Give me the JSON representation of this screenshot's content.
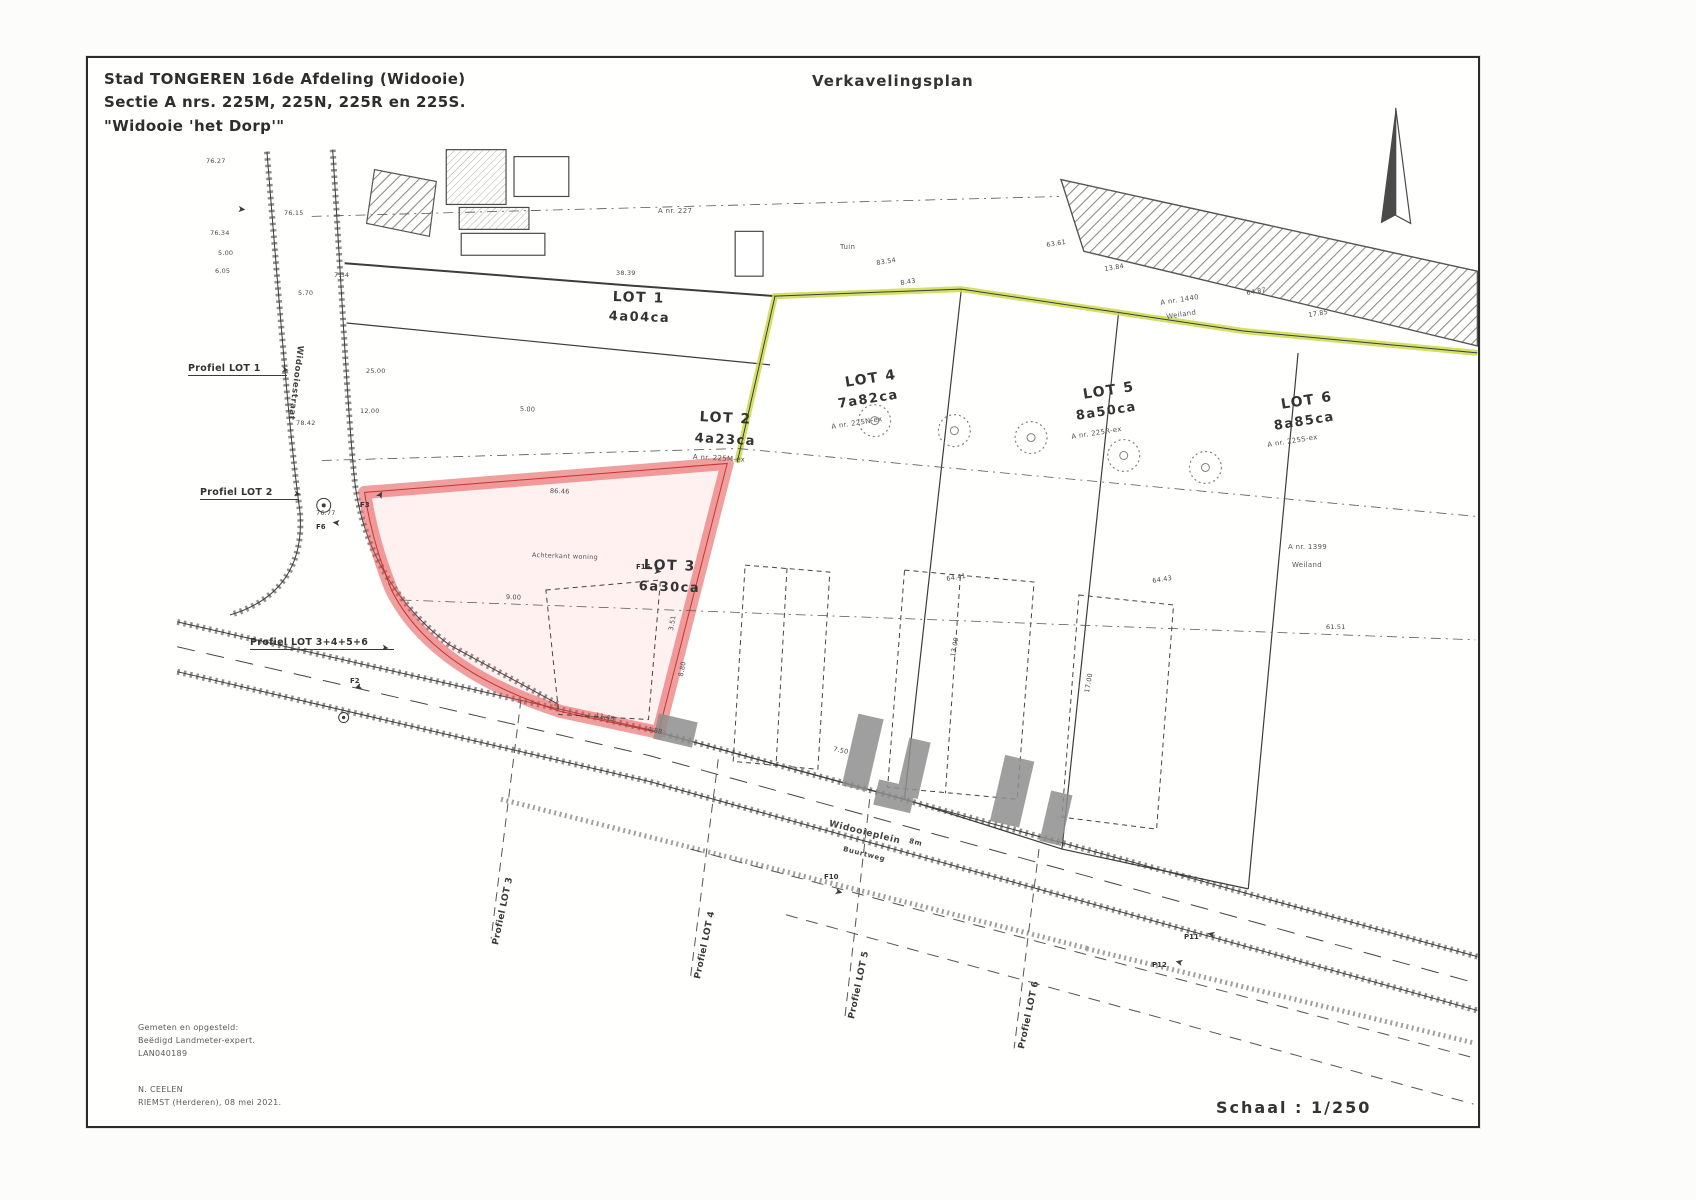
{
  "document": {
    "type": "Verkavelingsplan (subdivision plan)"
  },
  "title_block": {
    "line1": "Stad TONGEREN 16de Afdeling (Widooie)",
    "line2": "Sectie A nrs. 225M, 225N, 225R en 225S.",
    "line3": "\"Widooie 'het Dorp'\""
  },
  "plan_title": "Verkavelingsplan",
  "scale": {
    "label": "Schaal : 1/250"
  },
  "surveyor_block": {
    "line1": "Gemeten en opgesteld:",
    "line2": "Beëdigd Landmeter-expert.",
    "line3": "LAN040189"
  },
  "signature_block": {
    "line1": "N. CEELEN",
    "line2": "RIEMST (Herderen), 08 mei 2021."
  },
  "lots": [
    {
      "name": "LOT 1",
      "area": "4a04ca",
      "parcel_ref": ""
    },
    {
      "name": "LOT 2",
      "area": "4a23ca",
      "parcel_ref": "A nr. 225M-ex"
    },
    {
      "name": "LOT 3",
      "area": "6a30ca",
      "parcel_ref": "",
      "highlight": "red"
    },
    {
      "name": "LOT 4",
      "area": "7a82ca",
      "parcel_ref": "A nr. 225N-ex"
    },
    {
      "name": "LOT 5",
      "area": "8a50ca",
      "parcel_ref": "A nr. 225R-ex"
    },
    {
      "name": "LOT 6",
      "area": "8a85ca",
      "parcel_ref": "A nr. 225S-ex"
    }
  ],
  "colors": {
    "lot3_highlight": "#e45050",
    "boundary_green": "#cdd94a",
    "driveway_gray": "#8f8f8f",
    "ink": "#3b3b3b"
  },
  "labels": [
    {
      "t": "LOT 1",
      "x": 525,
      "y": 232,
      "fs": 14,
      "rot": 2,
      "cls": "lot"
    },
    {
      "t": "4a04ca",
      "x": 521,
      "y": 252,
      "fs": 13,
      "rot": 2,
      "cls": "lot"
    },
    {
      "t": "LOT 2",
      "x": 612,
      "y": 352,
      "fs": 14,
      "rot": 3,
      "cls": "lot"
    },
    {
      "t": "4a23ca",
      "x": 607,
      "y": 374,
      "fs": 13,
      "rot": 3,
      "cls": "lot"
    },
    {
      "t": "A nr. 225M-ex",
      "x": 605,
      "y": 396,
      "fs": 7,
      "rot": 3,
      "cls": "ref"
    },
    {
      "t": "LOT 3",
      "x": 556,
      "y": 500,
      "fs": 14,
      "rot": 2,
      "cls": "lot"
    },
    {
      "t": "6a30ca",
      "x": 551,
      "y": 522,
      "fs": 13,
      "rot": 2,
      "cls": "lot"
    },
    {
      "t": "LOT 4",
      "x": 756,
      "y": 318,
      "fs": 14,
      "rot": -9,
      "cls": "lot"
    },
    {
      "t": "7a82ca",
      "x": 749,
      "y": 340,
      "fs": 13,
      "rot": -9,
      "cls": "lot"
    },
    {
      "t": "A nr. 225N-ex",
      "x": 743,
      "y": 366,
      "fs": 7,
      "rot": -9,
      "cls": "ref"
    },
    {
      "t": "LOT 5",
      "x": 994,
      "y": 330,
      "fs": 14,
      "rot": -9,
      "cls": "lot"
    },
    {
      "t": "8a50ca",
      "x": 987,
      "y": 352,
      "fs": 13,
      "rot": -9,
      "cls": "lot"
    },
    {
      "t": "A nr. 225R-ex",
      "x": 983,
      "y": 376,
      "fs": 7,
      "rot": -9,
      "cls": "ref"
    },
    {
      "t": "LOT 6",
      "x": 1192,
      "y": 340,
      "fs": 14,
      "rot": -9,
      "cls": "lot"
    },
    {
      "t": "8a85ca",
      "x": 1185,
      "y": 362,
      "fs": 13,
      "rot": -9,
      "cls": "lot"
    },
    {
      "t": "A nr. 225S-ex",
      "x": 1179,
      "y": 384,
      "fs": 7,
      "rot": -9,
      "cls": "ref"
    },
    {
      "t": "A nr. 1440",
      "x": 1072,
      "y": 242,
      "fs": 7,
      "rot": -9,
      "cls": "ref"
    },
    {
      "t": "Weiland",
      "x": 1078,
      "y": 256,
      "fs": 7,
      "rot": -9,
      "cls": "ref"
    },
    {
      "t": "A nr. 1399",
      "x": 1200,
      "y": 486,
      "fs": 7,
      "cls": "ref"
    },
    {
      "t": "Weiland",
      "x": 1204,
      "y": 504,
      "fs": 7,
      "cls": "ref"
    },
    {
      "t": "A nr. 227",
      "x": 570,
      "y": 150,
      "fs": 7,
      "cls": "ref"
    },
    {
      "t": "Tuin",
      "x": 752,
      "y": 186,
      "fs": 7,
      "cls": "ref"
    },
    {
      "t": "Achterkant woning",
      "x": 444,
      "y": 494,
      "fs": 6.5,
      "rot": 2,
      "cls": "ref"
    },
    {
      "t": "Profiel LOT 1",
      "x": 100,
      "y": 306,
      "fs": 9.5,
      "cls": "prof"
    },
    {
      "t": "Profiel LOT 2",
      "x": 112,
      "y": 430,
      "fs": 9.5,
      "cls": "prof"
    },
    {
      "t": "Profiel LOT 3+4+5+6",
      "x": 162,
      "y": 580,
      "fs": 9.5,
      "cls": "prof"
    },
    {
      "t": "Profiel LOT 3",
      "x": 404,
      "y": 886,
      "fs": 9,
      "rot": -78,
      "cls": "prof2"
    },
    {
      "t": "Profiel LOT 4",
      "x": 606,
      "y": 920,
      "fs": 9,
      "rot": -78,
      "cls": "prof2"
    },
    {
      "t": "Profiel LOT 5",
      "x": 760,
      "y": 960,
      "fs": 9,
      "rot": -78,
      "cls": "prof2"
    },
    {
      "t": "Profiel LOT 6",
      "x": 930,
      "y": 990,
      "fs": 9,
      "rot": -78,
      "cls": "prof2"
    },
    {
      "t": "Widooieplein",
      "x": 742,
      "y": 762,
      "fs": 9,
      "rot": 14,
      "cls": "street"
    },
    {
      "t": "Buurtweg",
      "x": 756,
      "y": 788,
      "fs": 7,
      "rot": 14,
      "cls": "street"
    },
    {
      "t": "8m",
      "x": 822,
      "y": 780,
      "fs": 7,
      "rot": 14,
      "cls": "street"
    },
    {
      "t": "Widooiestraat",
      "x": 216,
      "y": 288,
      "fs": 8.5,
      "rot": 97,
      "cls": "street"
    },
    {
      "t": "76.27",
      "x": 118,
      "y": 100,
      "fs": 6.5,
      "cls": "meas"
    },
    {
      "t": "76.34",
      "x": 122,
      "y": 172,
      "fs": 6.5,
      "cls": "meas"
    },
    {
      "t": "5.00",
      "x": 130,
      "y": 192,
      "fs": 6.5,
      "cls": "meas"
    },
    {
      "t": "6.05",
      "x": 127,
      "y": 210,
      "fs": 6.5,
      "cls": "meas"
    },
    {
      "t": "76.15",
      "x": 196,
      "y": 152,
      "fs": 6.5,
      "cls": "meas"
    },
    {
      "t": "7.34",
      "x": 246,
      "y": 214,
      "fs": 6.5,
      "cls": "meas"
    },
    {
      "t": "5.70",
      "x": 210,
      "y": 232,
      "fs": 6.5,
      "cls": "meas"
    },
    {
      "t": "25.00",
      "x": 278,
      "y": 310,
      "fs": 6.5,
      "cls": "meas"
    },
    {
      "t": "12.00",
      "x": 272,
      "y": 350,
      "fs": 6.5,
      "cls": "meas"
    },
    {
      "t": "78.42",
      "x": 208,
      "y": 362,
      "fs": 6.5,
      "cls": "meas"
    },
    {
      "t": "76.77",
      "x": 228,
      "y": 452,
      "fs": 6.5,
      "cls": "meas"
    },
    {
      "t": "38.39",
      "x": 528,
      "y": 212,
      "fs": 6.5,
      "cls": "meas"
    },
    {
      "t": "83.54",
      "x": 788,
      "y": 202,
      "fs": 6.5,
      "rot": -9,
      "cls": "meas"
    },
    {
      "t": "8.43",
      "x": 812,
      "y": 222,
      "fs": 6.5,
      "rot": -9,
      "cls": "meas"
    },
    {
      "t": "63.61",
      "x": 958,
      "y": 184,
      "fs": 6.5,
      "rot": -9,
      "cls": "meas"
    },
    {
      "t": "13.84",
      "x": 1016,
      "y": 208,
      "fs": 6.5,
      "rot": -9,
      "cls": "meas"
    },
    {
      "t": "64.87",
      "x": 1158,
      "y": 232,
      "fs": 6.5,
      "rot": -9,
      "cls": "meas"
    },
    {
      "t": "17.85",
      "x": 1220,
      "y": 254,
      "fs": 6.5,
      "rot": -9,
      "cls": "meas"
    },
    {
      "t": "61.51",
      "x": 1238,
      "y": 566,
      "fs": 6.5,
      "cls": "meas"
    },
    {
      "t": "64.41",
      "x": 858,
      "y": 518,
      "fs": 6.5,
      "rot": -9,
      "cls": "meas"
    },
    {
      "t": "64.43",
      "x": 1064,
      "y": 520,
      "fs": 6.5,
      "rot": -9,
      "cls": "meas"
    },
    {
      "t": "86.46",
      "x": 462,
      "y": 430,
      "fs": 6.5,
      "rot": 2,
      "cls": "meas"
    },
    {
      "t": "11.48",
      "x": 508,
      "y": 654,
      "fs": 6.5,
      "rot": 12,
      "cls": "meas"
    },
    {
      "t": "4.88",
      "x": 560,
      "y": 668,
      "fs": 6.5,
      "rot": 12,
      "cls": "meas"
    },
    {
      "t": "3.51",
      "x": 580,
      "y": 572,
      "fs": 6.5,
      "rot": -80,
      "cls": "meas"
    },
    {
      "t": "8.80",
      "x": 590,
      "y": 618,
      "fs": 6.5,
      "rot": -80,
      "cls": "meas"
    },
    {
      "t": "13.00",
      "x": 862,
      "y": 598,
      "fs": 6.5,
      "rot": -80,
      "cls": "meas"
    },
    {
      "t": "17.00",
      "x": 996,
      "y": 634,
      "fs": 6.5,
      "rot": -80,
      "cls": "meas"
    },
    {
      "t": "7.50",
      "x": 746,
      "y": 688,
      "fs": 6.5,
      "rot": 12,
      "cls": "meas"
    },
    {
      "t": "9.00",
      "x": 418,
      "y": 536,
      "fs": 6.5,
      "rot": 2,
      "cls": "meas"
    },
    {
      "t": "5.00",
      "x": 432,
      "y": 348,
      "fs": 6.5,
      "rot": 2,
      "cls": "meas"
    },
    {
      "t": "F3",
      "x": 272,
      "y": 444,
      "fs": 7,
      "cls": "fp"
    },
    {
      "t": "F6",
      "x": 228,
      "y": 466,
      "fs": 7,
      "cls": "fp"
    },
    {
      "t": "F2",
      "x": 262,
      "y": 620,
      "fs": 7,
      "cls": "fp"
    },
    {
      "t": "F15",
      "x": 548,
      "y": 506,
      "fs": 7,
      "cls": "fp"
    },
    {
      "t": "F10",
      "x": 736,
      "y": 816,
      "fs": 7,
      "cls": "fp"
    },
    {
      "t": "P11",
      "x": 1096,
      "y": 876,
      "fs": 7,
      "cls": "fp"
    },
    {
      "t": "P12",
      "x": 1064,
      "y": 904,
      "fs": 7,
      "cls": "fp"
    },
    {
      "t": "➤",
      "x": 286,
      "y": 438,
      "fs": 10,
      "rot": -60,
      "cls": "ag"
    },
    {
      "t": "➤",
      "x": 252,
      "y": 470,
      "fs": 10,
      "rot": 185,
      "cls": "ag"
    },
    {
      "t": "➤",
      "x": 276,
      "y": 632,
      "fs": 10,
      "rot": 160,
      "cls": "ag"
    },
    {
      "t": "➤",
      "x": 566,
      "y": 508,
      "fs": 10,
      "rot": 5,
      "cls": "ag"
    },
    {
      "t": "➤",
      "x": 748,
      "y": 828,
      "fs": 10,
      "rot": 15,
      "cls": "ag"
    },
    {
      "t": "➤",
      "x": 1126,
      "y": 882,
      "fs": 10,
      "rot": 195,
      "cls": "ag"
    },
    {
      "t": "➤",
      "x": 1094,
      "y": 910,
      "fs": 10,
      "rot": 195,
      "cls": "ag"
    },
    {
      "t": "➤",
      "x": 150,
      "y": 146,
      "fs": 10,
      "rot": 5,
      "cls": "ag"
    },
    {
      "t": "➤",
      "x": 194,
      "y": 308,
      "fs": 9,
      "rot": 8,
      "cls": "ag"
    },
    {
      "t": "➤",
      "x": 206,
      "y": 432,
      "fs": 9,
      "rot": 8,
      "cls": "ag"
    },
    {
      "t": "➤",
      "x": 294,
      "y": 586,
      "fs": 9,
      "rot": 8,
      "cls": "ag"
    }
  ]
}
